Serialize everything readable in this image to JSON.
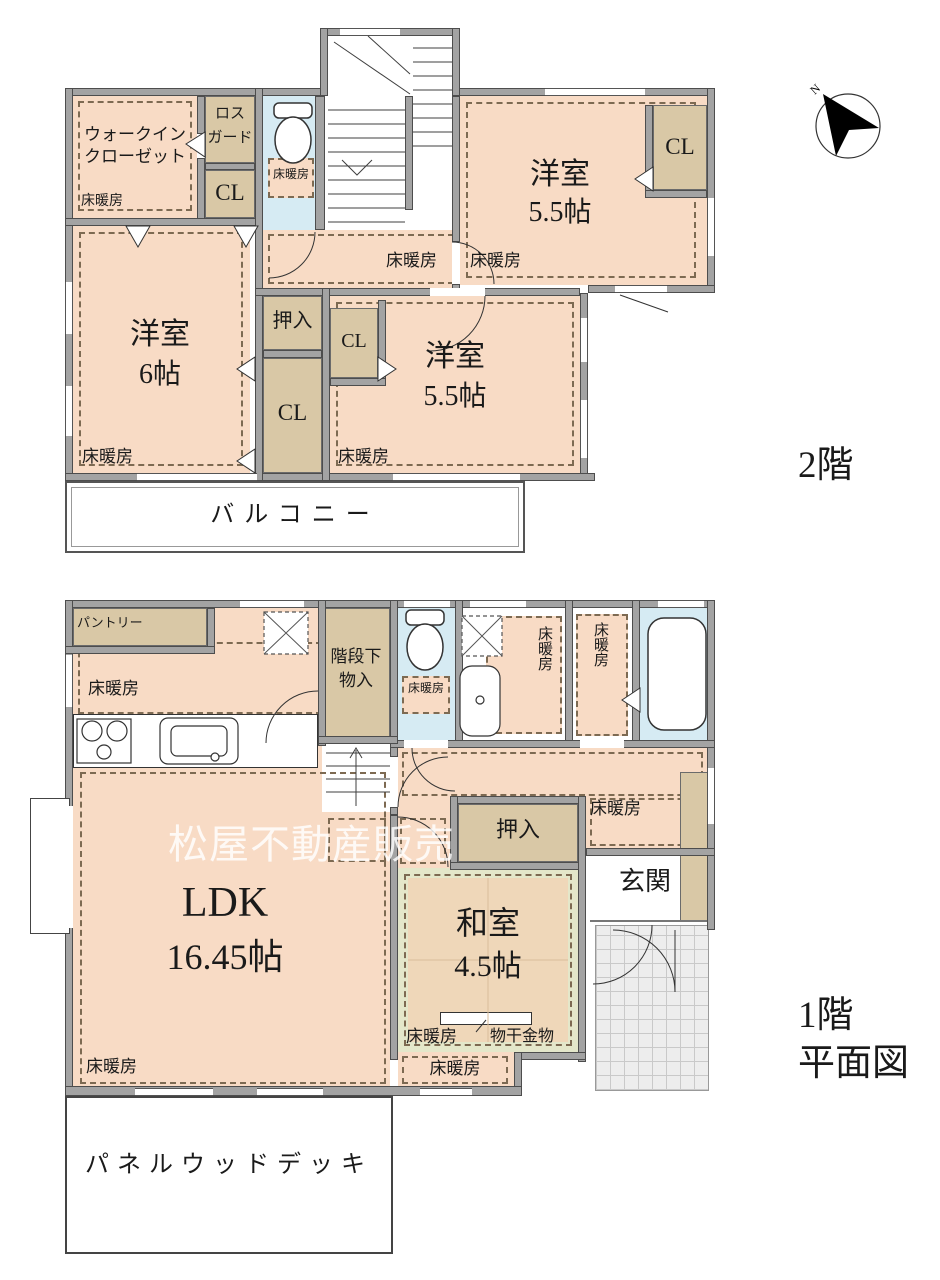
{
  "labels": {
    "floor_heating": "床暖房",
    "cl": "CL",
    "oshiire": "押入"
  },
  "floor2": {
    "title": "2階",
    "wic_line1": "ウォークイン",
    "wic_line2": "クローゼット",
    "loss_line1": "ロス",
    "loss_line2": "ガード",
    "room_ne_name": "洋室",
    "room_ne_size": "5.5帖",
    "room_w_name": "洋室",
    "room_w_size": "6帖",
    "room_c_name": "洋室",
    "room_c_size": "5.5帖",
    "balcony": "バルコニー"
  },
  "floor1": {
    "title": "1階",
    "subtitle": "平面図",
    "pantry": "パントリー",
    "stair_storage_line1": "階段下",
    "stair_storage_line2": "物入",
    "ldk_name": "LDK",
    "ldk_size": "16.45帖",
    "washitsu_name": "和室",
    "washitsu_size": "4.5帖",
    "genkan": "玄関",
    "monohoshi": "物干金物",
    "deck": "パネルウッドデッキ"
  },
  "compass": {
    "north": "N"
  },
  "watermark": "松屋不動産販売"
}
